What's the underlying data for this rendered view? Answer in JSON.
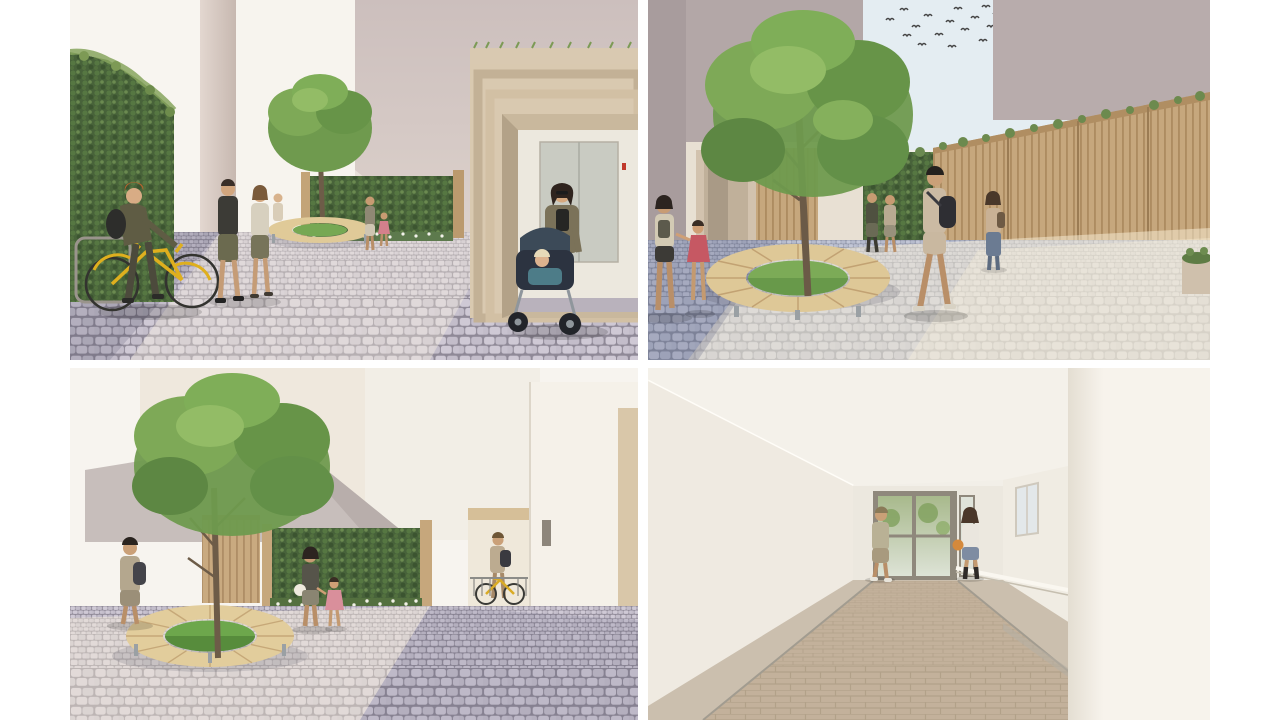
{
  "meta": {
    "type": "architectural-rendering-collage",
    "layout": "2x2-grid",
    "page_background": "#ffffff"
  },
  "palette": {
    "paving_shade": "#b9b3c2",
    "paving_sunlit": "#d9d2c6",
    "paving_blue_shade": "#a8aec2",
    "ivy_green": "#4c6639",
    "tree_green": "#6f9a4e",
    "timber_slat": "#c6a77d",
    "bench_wood": "#e0ca98",
    "grass": "#6da74c",
    "building_mauve": "#b3a7a7",
    "building_pink": "#cfc2c0",
    "building_cream": "#efe8dd",
    "sky": "#e4edf2",
    "bike_yellow": "#dfaf1e",
    "red_dress": "#c65863",
    "stroller_navy": "#2c3340",
    "corridor_floor": "#c3b19b",
    "elevator_door": "#c9cbc2",
    "indicator_red": "#c0392b"
  },
  "panels": [
    {
      "id": "courtyard-bike-elevator",
      "position": "top-left",
      "elements": [
        "ivy-hedge",
        "bike-rack",
        "yellow-bicycle",
        "cyclist",
        "walking-couple",
        "tree-with-circular-bench",
        "green-wall-with-flowers",
        "elevator-entrance-portal",
        "mother-with-stroller",
        "cobblestone-paving"
      ]
    },
    {
      "id": "courtyard-tree-fence",
      "position": "top-right",
      "elements": [
        "bird-flock",
        "sky",
        "large-tree",
        "circular-timber-bench",
        "timber-slat-fence",
        "ivy-wall",
        "entry-portal",
        "mother-and-child",
        "man-with-backpack",
        "standing-woman",
        "cobblestone-paving",
        "planter"
      ]
    },
    {
      "id": "courtyard-green-wall",
      "position": "bottom-left",
      "elements": [
        "tree",
        "circular-timber-bench",
        "living-green-wall",
        "timber-slat-panel",
        "bike-shed-passage",
        "man-with-backpack",
        "mother-and-child",
        "sloped-grey-wall",
        "cobblestone-paving"
      ]
    },
    {
      "id": "entrance-corridor",
      "position": "bottom-right",
      "elements": [
        "white-walls",
        "cove-ceiling-light",
        "glazed-entrance-door",
        "sidelight-window",
        "recessed-window",
        "handrail",
        "man-walking-away",
        "woman-with-ball",
        "brick-paved-floor"
      ]
    }
  ]
}
